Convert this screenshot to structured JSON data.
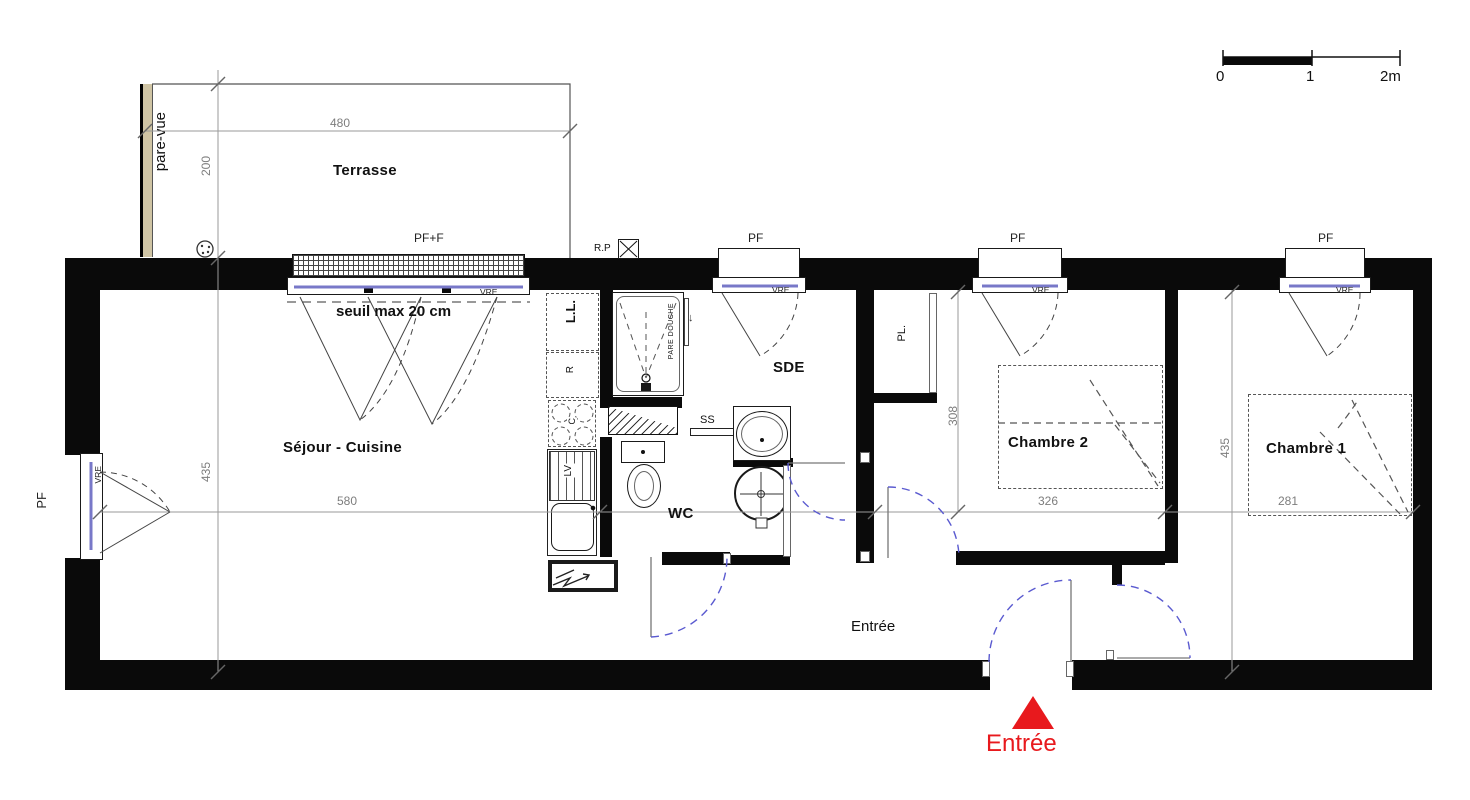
{
  "labels": {
    "terrace": "Terrasse",
    "living": "Séjour - Cuisine",
    "sde": "SDE",
    "wc": "WC",
    "bedroom2": "Chambre 2",
    "bedroom1": "Chambre 1",
    "hall": "Entrée",
    "entry_marker": "Entrée",
    "pare_vue": "pare-vue",
    "seuil": "seuil max 20 cm",
    "pf": "PF",
    "pf_f": "PF+F",
    "rp": "R.P",
    "vre": "VRE",
    "washer": "L.L.",
    "fridge": "R",
    "dishwasher": "LV",
    "hob": "C",
    "shelf": "SS",
    "closet": "PL.",
    "shower_screen": "PARE DOUCHE"
  },
  "dimensions": {
    "terrace_width": "480",
    "terrace_depth": "200",
    "living_depth": "435",
    "living_width": "580",
    "bedroom2_depth": "308",
    "bedroom2_width": "326",
    "bedroom1_width": "281",
    "bedroom1_depth": "435"
  },
  "scalebar": {
    "zero": "0",
    "one": "1",
    "two": "2m"
  },
  "colors": {
    "wall": "#0a0a0a",
    "door_arc": "#5a5ad0",
    "glazing": "#7878c8",
    "entry_red": "#e8191d",
    "pare_vue_fill": "#cfc4a4",
    "dim_line": "#8a8a8a"
  }
}
